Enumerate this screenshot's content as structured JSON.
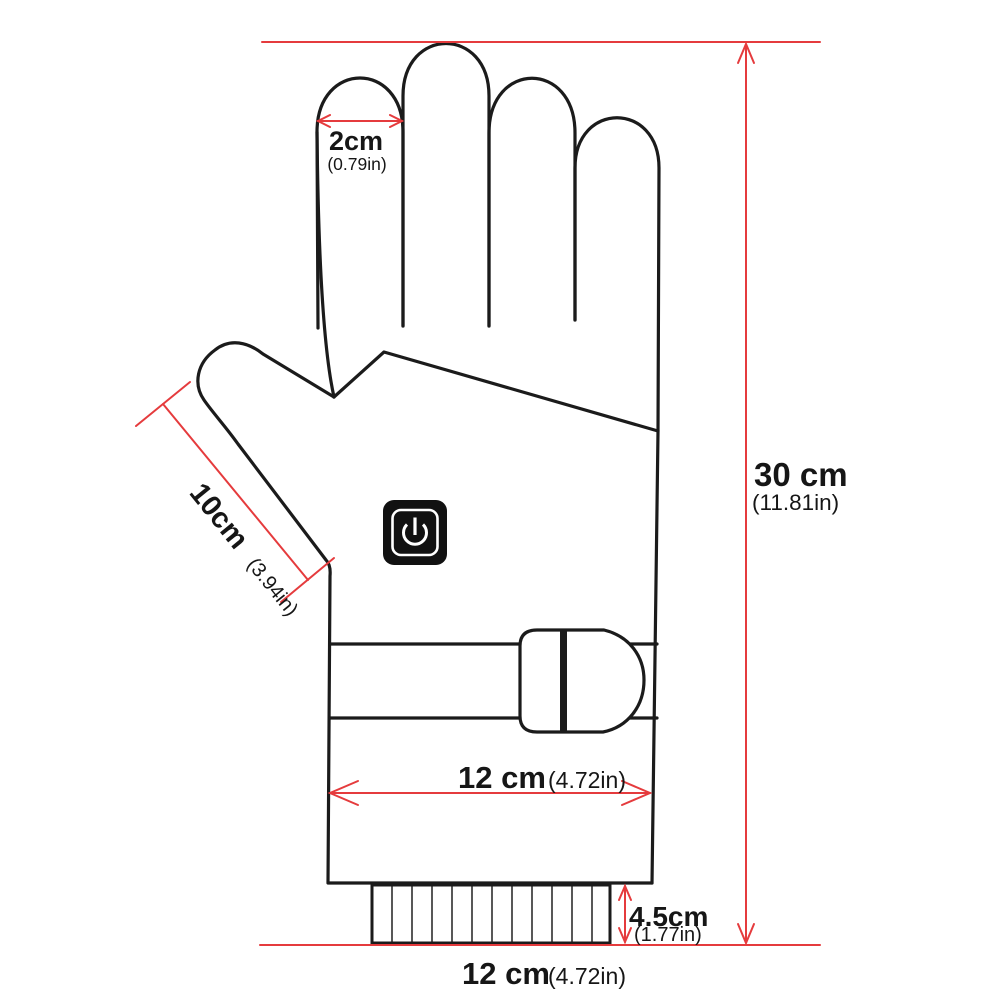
{
  "title": "Glove dimension diagram",
  "colors": {
    "dimension_red": "#e53b3d",
    "outline_black": "#1b1b1b",
    "background": "#ffffff",
    "power_button_bg": "#111111",
    "power_button_glyph": "#ffffff"
  },
  "labels": {
    "finger_width": {
      "value": "2cm",
      "inches": "(0.79in)"
    },
    "thumb_length": {
      "value": "10cm",
      "inches": "(3.94in)"
    },
    "glove_length": {
      "value": "30 cm",
      "inches": "(11.81in)"
    },
    "palm_width": {
      "value": "12 cm",
      "inches": "(4.72in)"
    },
    "cuff_height": {
      "value": "4.5cm",
      "inches": "(1.77in)"
    },
    "overall_width": {
      "value": "12 cm",
      "inches": "(4.72in)"
    }
  },
  "icons": {
    "power_button": "power-symbol"
  }
}
